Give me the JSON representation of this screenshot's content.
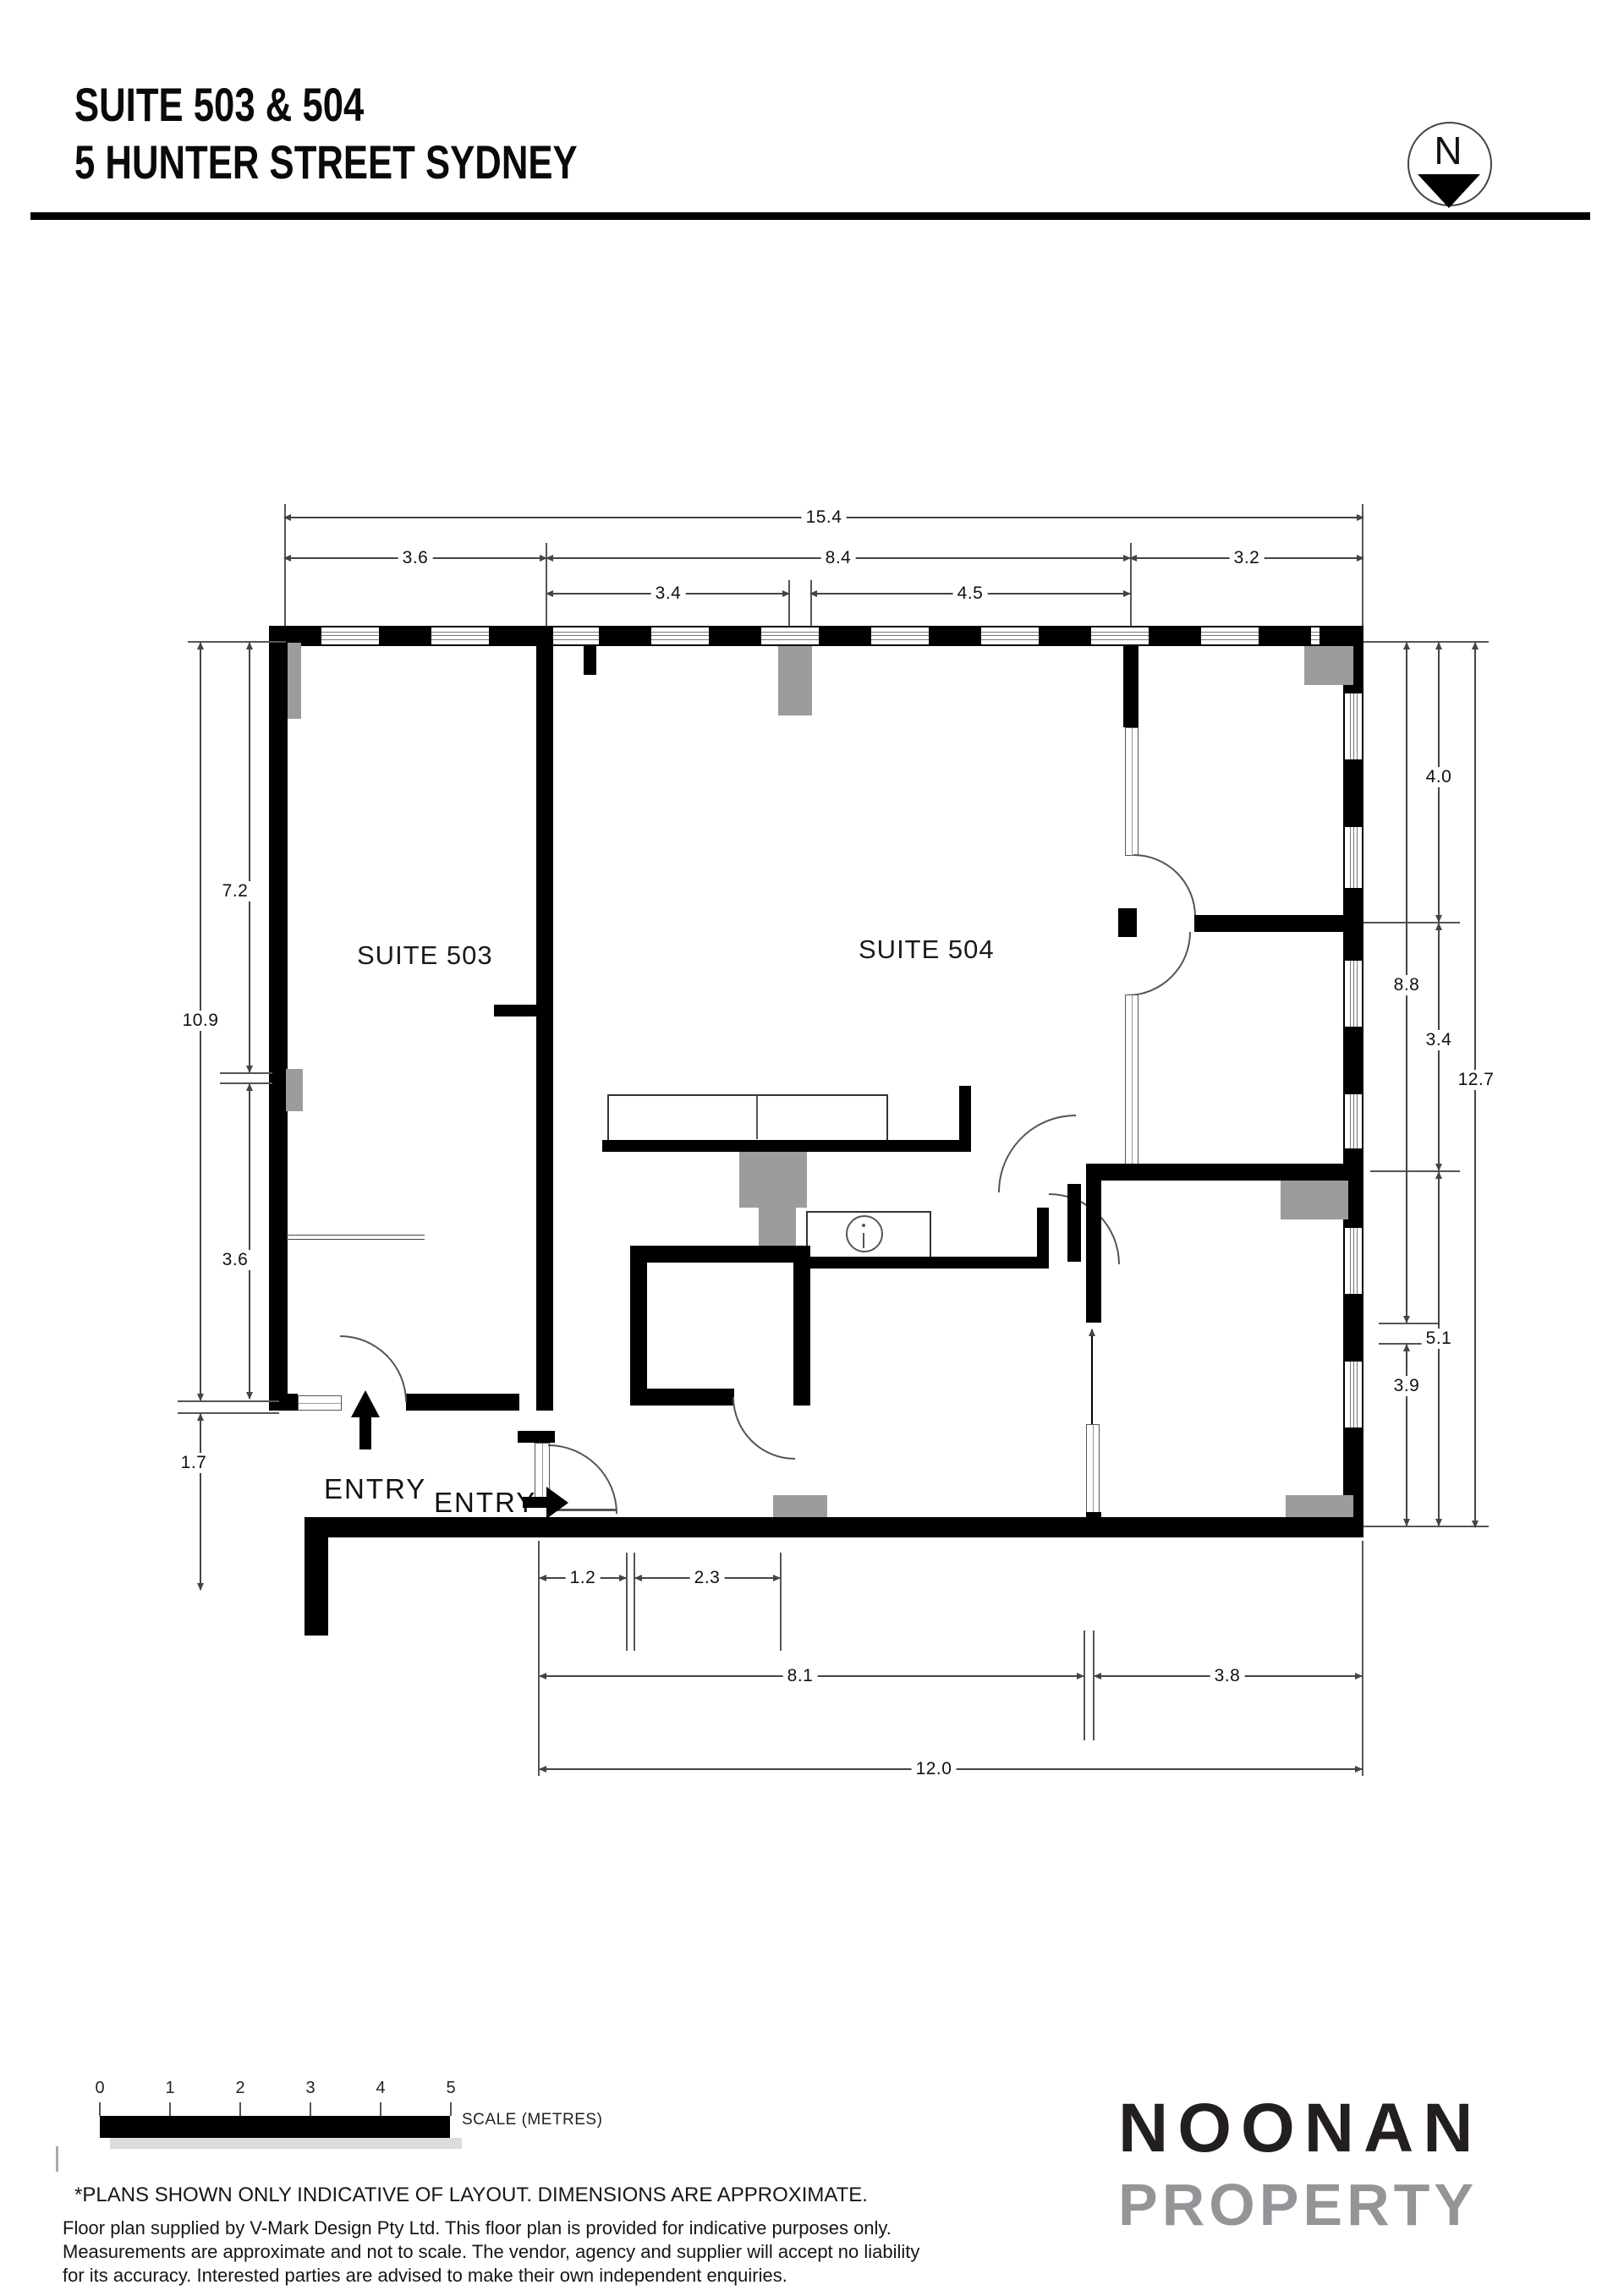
{
  "header": {
    "title_line1": "SUITE 503 & 504",
    "title_line2": "5 HUNTER STREET SYDNEY",
    "north_label": "N"
  },
  "plan": {
    "suite503_label": "SUITE 503",
    "suite504_label": "SUITE 504",
    "entry_label_1": "ENTRY",
    "entry_label_2": "ENTRY",
    "dimensions": {
      "top": [
        "15.4",
        "3.6",
        "8.4",
        "3.2",
        "3.4",
        "4.5"
      ],
      "left": [
        "7.2",
        "10.9",
        "3.6",
        "1.7"
      ],
      "right": [
        "4.0",
        "8.8",
        "3.4",
        "12.7",
        "5.1",
        "3.9"
      ],
      "bottom": [
        "1.2",
        "2.3",
        "8.1",
        "3.8",
        "12.0"
      ]
    },
    "colors": {
      "wall": "#000000",
      "column_gray": "#9c9c9c"
    }
  },
  "scale_bar": {
    "ticks": [
      "0",
      "1",
      "2",
      "3",
      "4",
      "5"
    ],
    "label": "SCALE (METRES)"
  },
  "footer": {
    "note": "*PLANS SHOWN ONLY INDICATIVE OF LAYOUT. DIMENSIONS ARE APPROXIMATE.",
    "disclaimer_line1": "Floor plan supplied by V-Mark Design Pty Ltd. This floor plan is provided for indicative purposes only.",
    "disclaimer_line2": "Measurements are approximate and not to scale. The vendor, agency and supplier will accept no liability",
    "disclaimer_line3": "for its accuracy. Interested parties are advised to make their own independent enquiries.",
    "logo_line1": "NOONAN",
    "logo_line2": "PROPERTY"
  }
}
